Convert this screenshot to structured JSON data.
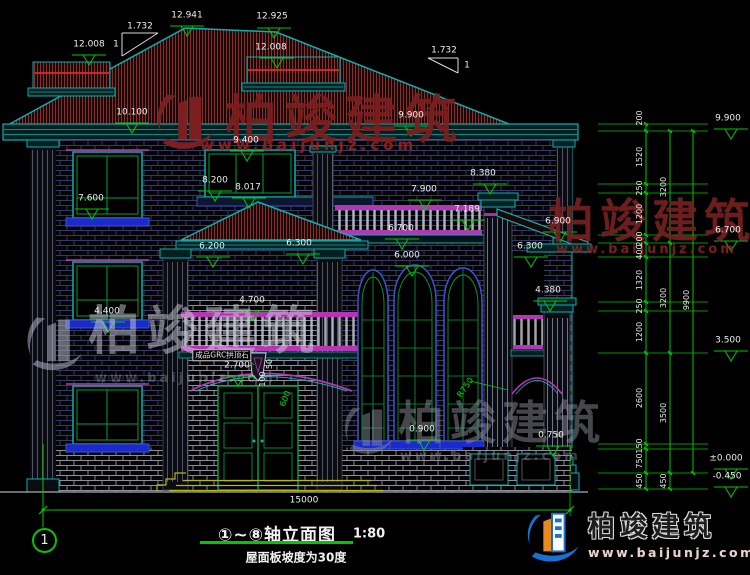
{
  "title_block": {
    "title": "①~⑧轴立面图",
    "scale": "1:80",
    "subtitle": "屋面板坡度为30度",
    "axis_start": "1"
  },
  "watermarks": {
    "top": {
      "text": "柏竣建筑",
      "url": "www.baijunjz.com"
    },
    "left": {
      "text": "柏竣建筑",
      "url": "www.baijunjz.com"
    },
    "center": {
      "text": "柏竣建筑",
      "url": "www.baijunjz.com"
    },
    "right": {
      "text": "柏竣建筑",
      "url": "www.baijunjz.com"
    }
  },
  "logo": {
    "name": "柏竣建筑",
    "url": "www.baijunjz.com"
  },
  "drawing": {
    "total_width_mm": "15000",
    "roof_slope_note": "屋面板坡度为30度",
    "keystone_note": "成品GRC拱顶石"
  },
  "annotations": {
    "labels": [
      {
        "t": "12.008",
        "x": 89,
        "y": 45,
        "cls": "ev"
      },
      {
        "t": "12.941",
        "x": 187,
        "y": 16,
        "cls": "ev"
      },
      {
        "t": "12.925",
        "x": 272,
        "y": 17,
        "cls": "ev"
      },
      {
        "t": "12.008",
        "x": 271,
        "y": 48,
        "cls": "ev"
      },
      {
        "t": "1.732",
        "x": 140,
        "y": 27,
        "cls": "ev"
      },
      {
        "t": "1",
        "x": 116,
        "y": 45,
        "cls": "ev"
      },
      {
        "t": "1.732",
        "x": 444,
        "y": 51,
        "cls": "ev"
      },
      {
        "t": "1",
        "x": 467,
        "y": 66,
        "cls": "ev"
      },
      {
        "t": "10.100",
        "x": 132,
        "y": 113,
        "cls": "ev"
      },
      {
        "t": "9.900",
        "x": 411,
        "y": 116,
        "cls": "ev"
      },
      {
        "t": "9.400",
        "x": 246,
        "y": 141,
        "cls": "ev"
      },
      {
        "t": "8.200",
        "x": 215,
        "y": 181,
        "cls": "ev"
      },
      {
        "t": "8.017",
        "x": 248,
        "y": 188,
        "cls": "ev"
      },
      {
        "t": "8.380",
        "x": 483,
        "y": 174,
        "cls": "ev"
      },
      {
        "t": "7.600",
        "x": 91,
        "y": 199,
        "cls": "ev"
      },
      {
        "t": "7.900",
        "x": 424,
        "y": 190,
        "cls": "ev"
      },
      {
        "t": "7.189",
        "x": 467,
        "y": 210,
        "cls": "ev"
      },
      {
        "t": "6.700",
        "x": 401,
        "y": 229,
        "cls": "ev"
      },
      {
        "t": "6.900",
        "x": 558,
        "y": 222,
        "cls": "ev"
      },
      {
        "t": "6.300",
        "x": 530,
        "y": 247,
        "cls": "ev"
      },
      {
        "t": "6.200",
        "x": 212,
        "y": 247,
        "cls": "ev"
      },
      {
        "t": "6.300",
        "x": 299,
        "y": 244,
        "cls": "ev"
      },
      {
        "t": "6.000",
        "x": 407,
        "y": 256,
        "cls": "ev"
      },
      {
        "t": "4.400",
        "x": 107,
        "y": 312,
        "cls": "ev"
      },
      {
        "t": "4.700",
        "x": 252,
        "y": 301,
        "cls": "ev"
      },
      {
        "t": "4.380",
        "x": 548,
        "y": 291,
        "cls": "ev"
      },
      {
        "t": "2.700",
        "x": 237,
        "y": 366,
        "cls": "ev"
      },
      {
        "t": "0.900",
        "x": 422,
        "y": 430,
        "cls": "ev"
      },
      {
        "t": "0.750",
        "x": 551,
        "y": 436,
        "cls": "ev"
      },
      {
        "t": "9.900",
        "x": 728,
        "y": 119,
        "cls": "ev"
      },
      {
        "t": "6.700",
        "x": 728,
        "y": 231,
        "cls": "ev"
      },
      {
        "t": "3.500",
        "x": 728,
        "y": 341,
        "cls": "ev"
      },
      {
        "t": "±0.000",
        "x": 726,
        "y": 459,
        "cls": "ev"
      },
      {
        "t": "-0.450",
        "x": 727,
        "y": 477,
        "cls": "ev"
      },
      {
        "t": "15000",
        "x": 304,
        "y": 501,
        "cls": "ev"
      },
      {
        "t": "200",
        "x": 640,
        "y": 118,
        "rot": -90,
        "cls": "dim"
      },
      {
        "t": "1520",
        "x": 640,
        "y": 157,
        "rot": -90,
        "cls": "dim"
      },
      {
        "t": "250",
        "x": 640,
        "y": 188,
        "rot": -90,
        "cls": "dim"
      },
      {
        "t": "1200",
        "x": 640,
        "y": 214,
        "rot": -90,
        "cls": "dim"
      },
      {
        "t": "200",
        "x": 640,
        "y": 239,
        "rot": -90,
        "cls": "dim"
      },
      {
        "t": "400",
        "x": 640,
        "y": 252,
        "rot": -90,
        "cls": "dim"
      },
      {
        "t": "1320",
        "x": 640,
        "y": 280,
        "rot": -90,
        "cls": "dim"
      },
      {
        "t": "250",
        "x": 640,
        "y": 306,
        "rot": -90,
        "cls": "dim"
      },
      {
        "t": "1200",
        "x": 640,
        "y": 332,
        "rot": -90,
        "cls": "dim"
      },
      {
        "t": "2600",
        "x": 640,
        "y": 398,
        "rot": -90,
        "cls": "dim"
      },
      {
        "t": "150",
        "x": 640,
        "y": 446,
        "rot": -90,
        "cls": "dim"
      },
      {
        "t": "750",
        "x": 640,
        "y": 461,
        "rot": -90,
        "cls": "dim"
      },
      {
        "t": "450",
        "x": 640,
        "y": 481,
        "rot": -90,
        "cls": "dim"
      },
      {
        "t": "3200",
        "x": 664,
        "y": 187,
        "rot": -90,
        "cls": "dim"
      },
      {
        "t": "3200",
        "x": 664,
        "y": 298,
        "rot": -90,
        "cls": "dim"
      },
      {
        "t": "3500",
        "x": 664,
        "y": 413,
        "rot": -90,
        "cls": "dim"
      },
      {
        "t": "450",
        "x": 664,
        "y": 481,
        "rot": -90,
        "cls": "dim"
      },
      {
        "t": "9900",
        "x": 687,
        "y": 300,
        "rot": -90,
        "cls": "dim"
      },
      {
        "t": "100",
        "x": 263,
        "y": 379,
        "rot": -90,
        "cls": "dim"
      },
      {
        "t": "50",
        "x": 270,
        "y": 364,
        "rot": -90,
        "cls": "dim"
      },
      {
        "t": "600",
        "x": 286,
        "y": 399,
        "rot": -68,
        "cls": "dimg"
      },
      {
        "t": "R750",
        "x": 466,
        "y": 388,
        "rot": -55,
        "cls": "dimg"
      },
      {
        "t": "成品GRC拱顶石",
        "x": 222,
        "y": 355,
        "cls": "boxed"
      }
    ],
    "elevation_markers": [
      {
        "x": 89,
        "y": 55
      },
      {
        "x": 187,
        "y": 26
      },
      {
        "x": 274,
        "y": 28
      },
      {
        "x": 277,
        "y": 58
      },
      {
        "x": 132,
        "y": 123
      },
      {
        "x": 411,
        "y": 126
      },
      {
        "x": 247,
        "y": 151
      },
      {
        "x": 215,
        "y": 191
      },
      {
        "x": 249,
        "y": 198
      },
      {
        "x": 490,
        "y": 184
      },
      {
        "x": 92,
        "y": 209
      },
      {
        "x": 425,
        "y": 200
      },
      {
        "x": 468,
        "y": 220
      },
      {
        "x": 402,
        "y": 239
      },
      {
        "x": 560,
        "y": 232
      },
      {
        "x": 531,
        "y": 257
      },
      {
        "x": 213,
        "y": 257
      },
      {
        "x": 303,
        "y": 254
      },
      {
        "x": 412,
        "y": 266
      },
      {
        "x": 108,
        "y": 322
      },
      {
        "x": 253,
        "y": 311
      },
      {
        "x": 550,
        "y": 301
      },
      {
        "x": 238,
        "y": 376
      },
      {
        "x": 424,
        "y": 440
      },
      {
        "x": 553,
        "y": 446
      },
      {
        "x": 731,
        "y": 129
      },
      {
        "x": 731,
        "y": 241
      },
      {
        "x": 731,
        "y": 351
      },
      {
        "x": 731,
        "y": 469
      },
      {
        "x": 731,
        "y": 487
      }
    ],
    "dim_chain_right": {
      "ext_x0": 598,
      "ext_x1": 708,
      "columns": [
        {
          "x": 646,
          "levels": [
            124,
            131,
            184,
            193,
            235,
            243,
            257,
            302,
            311,
            353,
            444,
            449,
            473,
            489
          ]
        },
        {
          "x": 670,
          "levels": [
            131,
            243,
            353,
            473,
            489
          ]
        },
        {
          "x": 693,
          "levels": [
            131,
            473
          ]
        }
      ]
    }
  }
}
